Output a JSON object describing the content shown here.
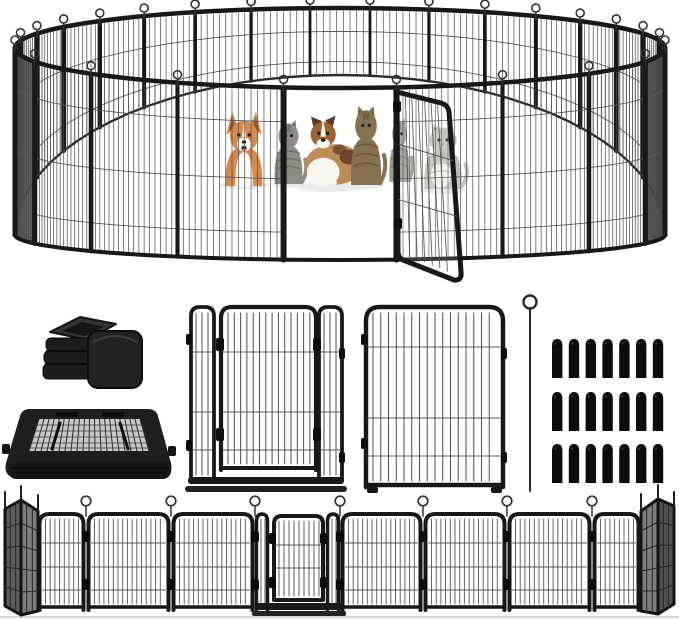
{
  "image": {
    "kind": "product-collage",
    "subject": "Heavy-duty black metal dog playpen shown as a circular pen with pets inside and an open gate, plus separate gate panel, fence panel, folded panel stack, rubber foot caps, ground anchor pin and plastic stakes, and a flattened row of panels",
    "background": "#ffffff"
  },
  "palette": {
    "frame": "#181818",
    "frame_soft": "#2d2d2d",
    "wire": "#4d4d4d",
    "rail": "#5a5a5a",
    "shade_dark": "#4f4f4f",
    "shade_mid": "#6e6e6e",
    "stake": "#0b0b0b",
    "ground": "#d9d9d9",
    "shadow": "#ebebe9"
  },
  "pen": {
    "back_panels": 17,
    "front_panels": 9,
    "wires_per_back_panel": 8,
    "wires_per_front_panel": 16,
    "back_rails": [
      0.35,
      0.8
    ],
    "front_rails": [
      0.2,
      0.53,
      0.84
    ],
    "gate": {
      "state": "open",
      "hinge": "right"
    },
    "animals": [
      {
        "name": "corgi-dog",
        "coat": "#d68a4d",
        "accent": "#fcf9f4"
      },
      {
        "name": "gray-tabby-cat",
        "coat": "#8d8b83",
        "stripe": "#5e5c54"
      },
      {
        "name": "australian-shepherd-dog",
        "coat": "#9c6136",
        "coat2": "#bb8d58",
        "accent": "#f8f5ef",
        "patch": "#5a3b26"
      },
      {
        "name": "brown-tabby-cat",
        "coat": "#84714f",
        "stripe": "#57462e"
      },
      {
        "name": "gray-cat-behind-door",
        "coat": "#9b988f",
        "stripe": "#6e6b62"
      },
      {
        "name": "light-gray-cat",
        "coat": "#c6c2b8",
        "stripe": "#a39f94",
        "chest": "#f3f1ea"
      }
    ]
  },
  "accessories": {
    "foot_caps": {
      "pieces": 2
    },
    "folded_panel_stack": {
      "present": true
    },
    "gate_panel": {
      "doors": 1
    },
    "fence_panel": {
      "count": 1
    },
    "anchor_pin": {
      "count": 1
    },
    "stakes": {
      "rows": 3,
      "cols": 7,
      "total": 21
    }
  },
  "bottom_row": {
    "flat_panels": 7,
    "angled_panels_left": 2,
    "angled_panels_right": 2,
    "door_panels": 1,
    "joint_pins": 7
  }
}
